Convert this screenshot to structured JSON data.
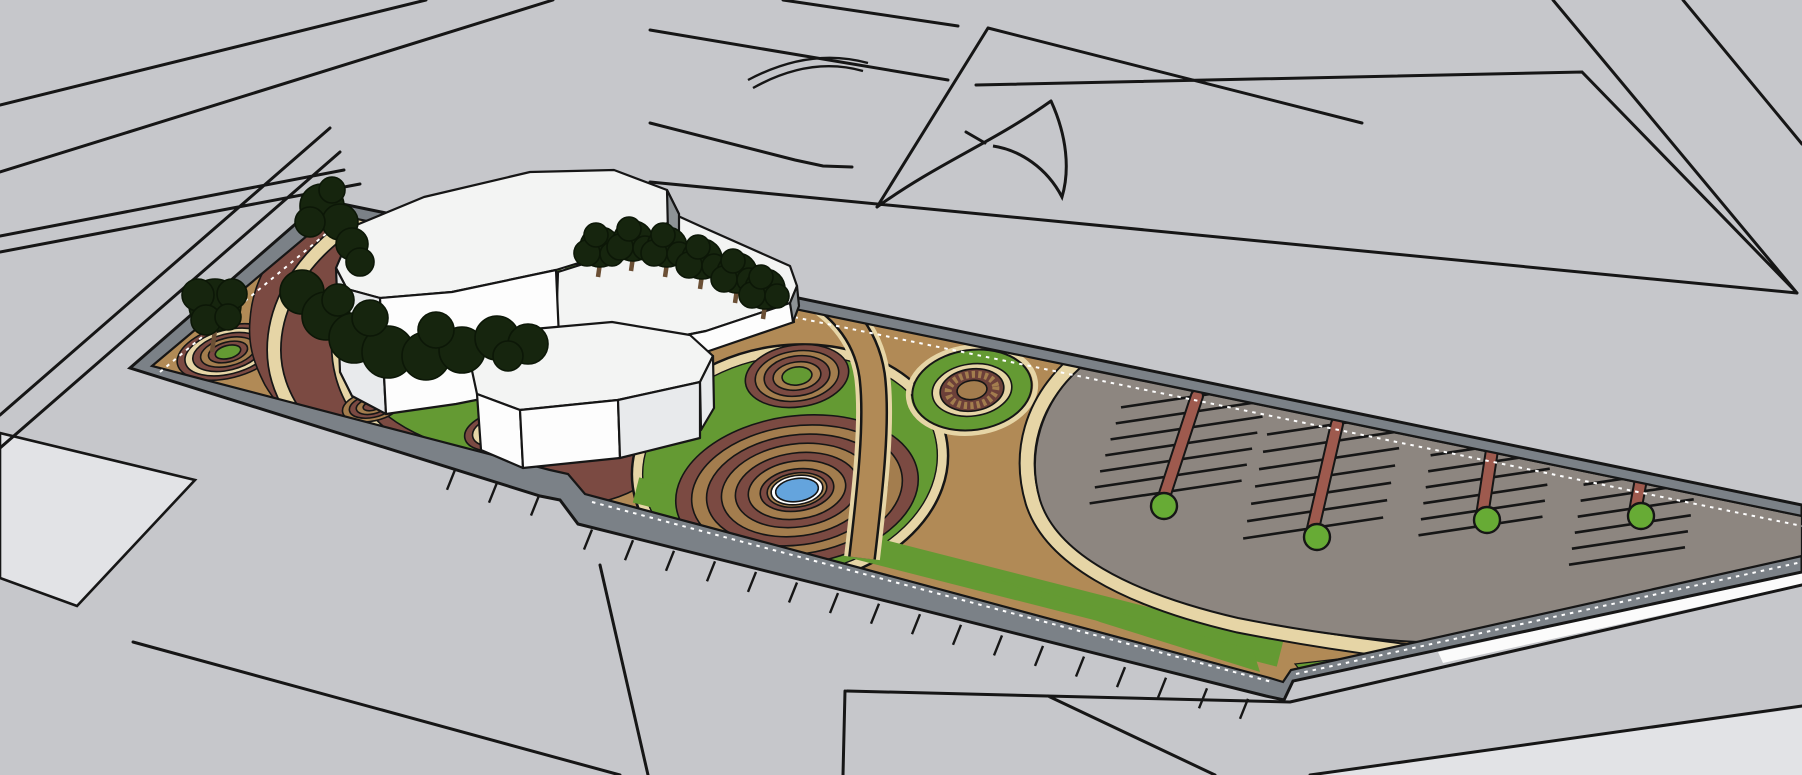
{
  "app": {
    "name": "3d-site-model-viewport",
    "view_type": "perspective aerial view",
    "subject": "landscape site plan with building, circular gardens, fountain and parking"
  },
  "colors": {
    "background": "#c6c7cb",
    "background_light": "#e2e3e6",
    "line": "#161616",
    "curb": "#7b8187",
    "curb_dash": "#ffffff",
    "ground_tan": "#b18a56",
    "path_cream": "#e6d5a6",
    "ring_tan": "#a37d4e",
    "soil_maroon": "#7b4a42",
    "soil_maroon_dark": "#6c4039",
    "grass_green": "#649a33",
    "tree_dark": "#16250e",
    "tree_outline": "#0c1707",
    "trunk_brown": "#6b4f35",
    "pond_blue": "#64a4dd",
    "pond_rim": "#ffffff",
    "parking_gray": "#8d8680",
    "stall_divider": "#9e5a4e",
    "stall_tree": "#67ab35",
    "building_roof": "#f3f4f3",
    "building_front": "#fdfdfd",
    "building_side": "#e8eaec",
    "building_side_dark": "#8e9396",
    "highlight_white": "#fbfbfb"
  },
  "site": {
    "building": {
      "masses": 3,
      "style": "white faceted low-poly blocks"
    },
    "fountain": {
      "alternating_rings": 8,
      "pond": "blue oval pool with white rim"
    },
    "ornament_circles": {
      "left_tip_rings": 1,
      "near_building_rings": 2,
      "upper_green_center_rings": 1,
      "gear_spoke_circle": 1
    },
    "parking": {
      "rows": 4,
      "stall_lines_per_row": [
        7,
        7,
        6,
        6
      ],
      "end_trees": 4,
      "divider": "red-brown strip with green tree circle at end"
    },
    "trees": {
      "left_tip_tree": 1,
      "corner_trees": 2,
      "building_cluster_canopies": 12,
      "top_row_trees": 6
    },
    "paths": "cream-edged tan walkways curving through green lawns",
    "edge": "gray curb band with white dashed hatch and outer tick marks"
  },
  "background_scene": {
    "streets": "light gray ground with black road and parcel line-work",
    "curved_marks": [
      "double arc road marking",
      "concave swoosh parcel curve"
    ]
  }
}
